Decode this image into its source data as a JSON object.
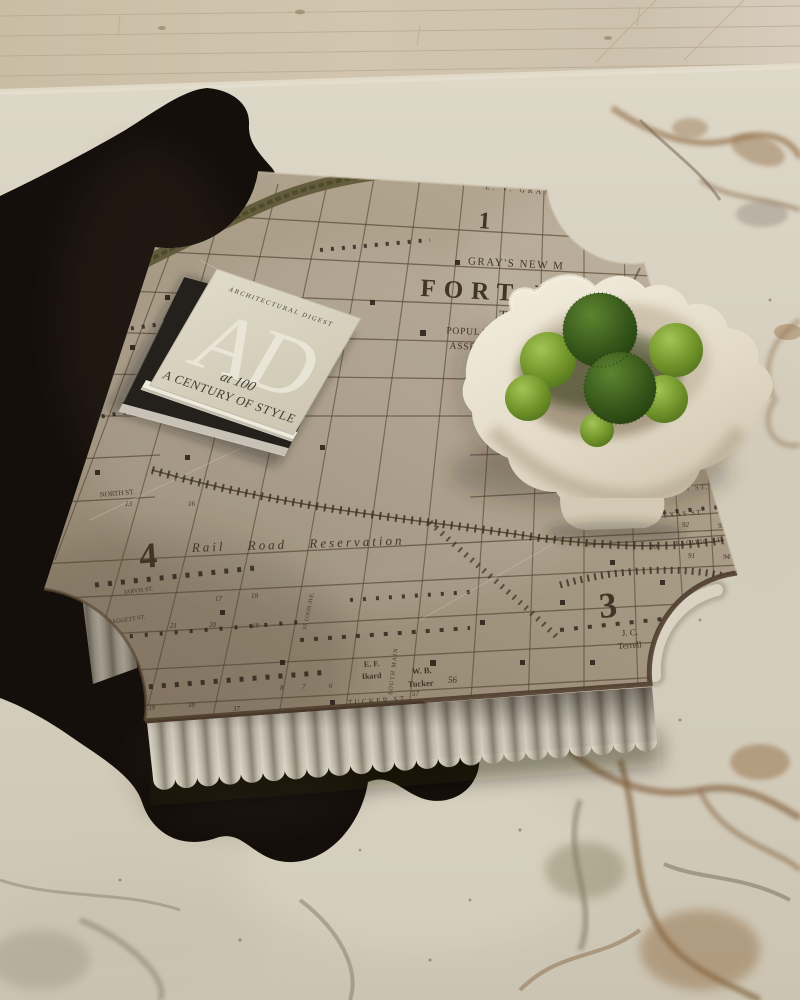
{
  "palette": {
    "wood_floor": "#cfc2ac",
    "rug_ivory": "#d7d0c0",
    "vein_rust": "#8a6a4a",
    "vein_gray": "#6f675c",
    "cowhide_black": "#150f0b",
    "map_base": "#a2947f",
    "map_ink": "#3c3226",
    "fluted_base": "#c0b9ab",
    "bowl_white": "#e6dfcf",
    "moss_dark": "#2f4f16",
    "moss_light": "#7da13a",
    "book_cover": "#d8d2c2"
  },
  "map": {
    "publisher_line": "GRAY'S NEW M",
    "title": "FORT W",
    "state": "TEX",
    "stat_line1": "POPULATION IN",
    "stat_line2": "ASSESSED VALU",
    "corner_label": "E. V. GRANT",
    "reservation": "Rail Road Reservation",
    "sections": {
      "s1": "1",
      "s2": "2",
      "s3": "3",
      "s4": "4"
    },
    "streets": {
      "north": "NORTH ST.",
      "jarvis": "JARVIS ST.",
      "daggett": "DAGGETT ST.",
      "tucker": "TUCKER ST.",
      "kennedy": "KENNEDY ST.",
      "texas": "TEXAS ST.",
      "pacific": "PACIFIC ST.",
      "railway": "RAILWAY",
      "south_main": "SOUTH MAIN",
      "st_louis": "ST. LOUIS AVE.",
      "wheeler": "WHEELER",
      "water_works": "WATER WORKS"
    },
    "owners": {
      "terrell_1": "J. C.",
      "terrell_2": "Terrell",
      "ikard_1": "E. F.",
      "ikard_2": "Ikard",
      "tucker_1": "W. B.",
      "tucker_2": "Tucker"
    },
    "blocks": {
      "n39": "39",
      "n38": "38",
      "n37": "37",
      "n8": "8",
      "n7": "7",
      "n6": "6",
      "n9": "9",
      "n10": "10",
      "n11": "11",
      "n12": "12",
      "n34": "34",
      "n43": "43",
      "n57": "57",
      "n56": "56",
      "n21": "21",
      "n20": "20",
      "n19": "19",
      "n17": "17",
      "n18": "18",
      "n13": "13",
      "n16": "16",
      "n88": "88",
      "n89": "89",
      "n92": "92",
      "n93": "93",
      "n97": "97",
      "n90": "90",
      "n91": "91",
      "n94": "94",
      "n96": "96",
      "n95": "95"
    }
  },
  "book": {
    "brand": "ARCHITECTURAL DIGEST",
    "monogram": "AD",
    "edition": "at 100",
    "subtitle": "A CENTURY OF STYLE"
  }
}
